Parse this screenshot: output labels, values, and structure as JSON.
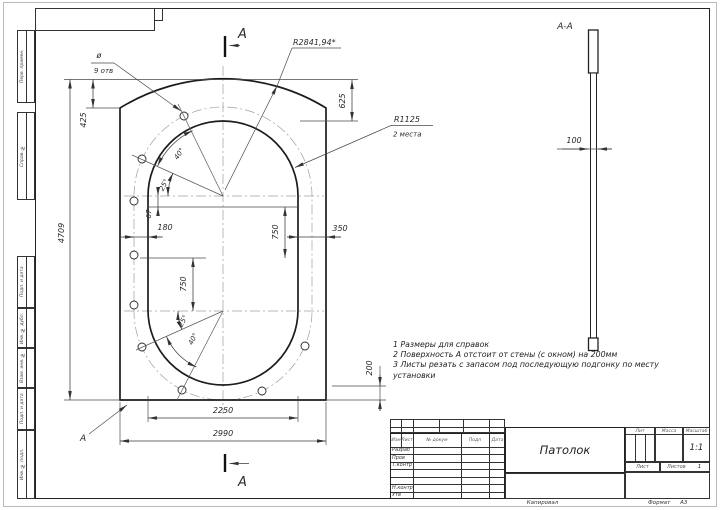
{
  "drawing": {
    "title_block": {
      "name_value": "Патолок",
      "header_cols": [
        "Изм",
        "Лист",
        "№ докум",
        "Подп",
        "Дата"
      ],
      "row_labels": [
        "Разраб",
        "Пров",
        "Т.контр",
        "Н.контр",
        "Утв"
      ],
      "lit_label": "Лит",
      "mass_label": "Масса",
      "scale_label": "Масштаб",
      "scale_value": "1:1",
      "sheet_label": "Лист",
      "sheets_label": "Листов",
      "sheets_value": "1",
      "copied_label": "Капировал",
      "format_label": "Формат",
      "format_value": "А3"
    },
    "margin_labels": {
      "perv": "Перв. примен.",
      "sprav": "Справ. №",
      "podp1": "Подп. и дата",
      "inv_dubl": "Инв. № дубл.",
      "vzam": "Взам. инв. №",
      "podp2": "Подп. и дата",
      "inv_podl": "Инв. № подл."
    },
    "notes": {
      "line1": "1  Размеры для справок",
      "line2": "2  Поверхность А отстоит от стены (с окном) на 200мм",
      "line3": "3  Листы резать с запасом под последующую подгонку по месту",
      "line4": "установки"
    },
    "dims": {
      "overall_height": "4709",
      "top_drop": "425",
      "arc_rise": "625",
      "gap_left": "180",
      "gap_right": "350",
      "center_offset": "67",
      "upper_span": "750",
      "lower_span": "750",
      "cutout_width": "2250",
      "overall_width": "2990",
      "bottom_gap": "200",
      "thickness": "100"
    },
    "labels": {
      "section_letter_top": "А",
      "section_letter_bottom": "А",
      "section_view": "А-А",
      "surface": "А",
      "outer_radius": "R2841,94*",
      "inner_radius": "R1125",
      "inner_radius_qty": "2 места",
      "holes_dia": "ø",
      "holes_qty": "9 отв",
      "angle_top_small": "25°",
      "angle_top_large": "40°",
      "angle_bottom_small": "25°",
      "angle_bottom_large": "40°"
    }
  }
}
